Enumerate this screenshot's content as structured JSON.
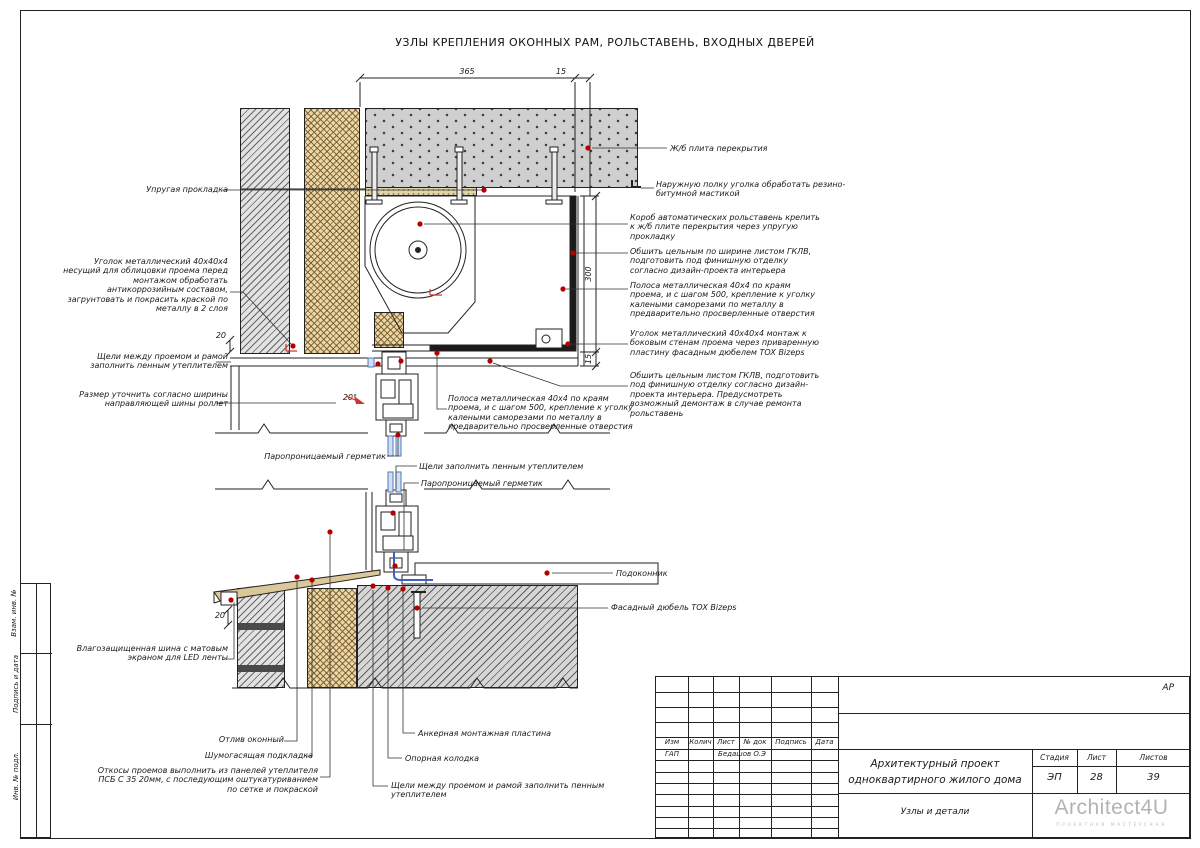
{
  "sheet": {
    "title": "УЗЛЫ КРЕПЛЕНИЯ ОКОННЫХ РАМ, РОЛЬСТАВЕНЬ, ВХОДНЫХ ДВЕРЕЙ",
    "code": "АР"
  },
  "dims": {
    "top_main": "365",
    "top_small": "15",
    "right_main": "300",
    "right_small": "15",
    "left_small": "20",
    "angle": "20°",
    "bottom_small": "20"
  },
  "ann": {
    "uprugaya": "Упругая прокладка",
    "ugolok_left": "Уголок металлический 40х40х4 несущий для облицовки проема перед монтажом обработать антикоррозийным составом, загрунтовать и покрасить краской по металлу в 2 слоя",
    "sheli": "Щели между проемом и рамой заполнить пенным утеплителем",
    "razmer": "Размер уточнить согласно ширины направляющей шины роллет",
    "plita": "Ж/б плита перекрытия",
    "naruzh": "Наружную полку уголка обработать резино-битумной мастикой",
    "korob": "Короб автоматических рольставень крепить к ж/б плите перекрытия через упругую прокладку",
    "obshit1": "Обшить цельным по ширине листом ГКЛВ, подготовить под финишную отделку согласно дизайн-проекта интерьера",
    "polosa": "Полоса металлическая 40х4 по краям проема, и с шагом 500, крепление к уголку калеными саморезами по металлу в предварительно просверленные отверстия",
    "ugolok_right": "Уголок металлический 40х40х4 монтаж к боковым стенам проема через приваренную пластину фасадным дюбелем TOX Bizeps",
    "obshit2": "Обшить цельным листом ГКЛВ, подготовить под финишную отделку согласно дизайн-проекта интерьера. Предусмотреть возможный демонтаж в случае ремонта рольставень",
    "paro": "Паропроницаемый герметик",
    "sheli_center": "Щели заполнить пенным утеплителем",
    "podokonnik": "Подоконник",
    "dubel": "Фасадный дюбель TOX Bizeps",
    "shina": "Влагозащищенная шина с матовым экраном для LED ленты",
    "otliv": "Отлив оконный",
    "shumo": "Шумогасящая подкладка",
    "otkosy": "Откосы проемов выполнить из панелей утеплителя ПСБ С 35 20мм, с последующим оштукатуриванием по сетке и покраской",
    "anker": "Анкерная монтажная пластина",
    "opora": "Опорная колодка"
  },
  "sidebar": {
    "vzam": "Взам. инв. №",
    "podp": "Подпись и дата",
    "inv": "Инв. № подл."
  },
  "titleblock": {
    "code": "АР",
    "headers": [
      "Изм",
      "Колич",
      "Лист",
      "№ док",
      "Подпись",
      "Дата"
    ],
    "role": "ГАП",
    "name": "Бедашов О.Э",
    "project": "Архитектурный проект одноквартирного жилого дома",
    "doc_title": "Узлы и детали",
    "stage_label": "Стадия",
    "sheet_label": "Лист",
    "sheets_label": "Листов",
    "stage": "ЭП",
    "sheet_no": "28",
    "sheets_total": "39",
    "logo": "Architect4U",
    "logo_sub": "ПРОЕКТНАЯ МАСТЕРСКАЯ"
  },
  "colors": {
    "marker_red": "#b30000",
    "seal_blue": "#4060c0",
    "insulation_tan": "#ead7a8",
    "hatch_gray": "#d6d6d6"
  }
}
